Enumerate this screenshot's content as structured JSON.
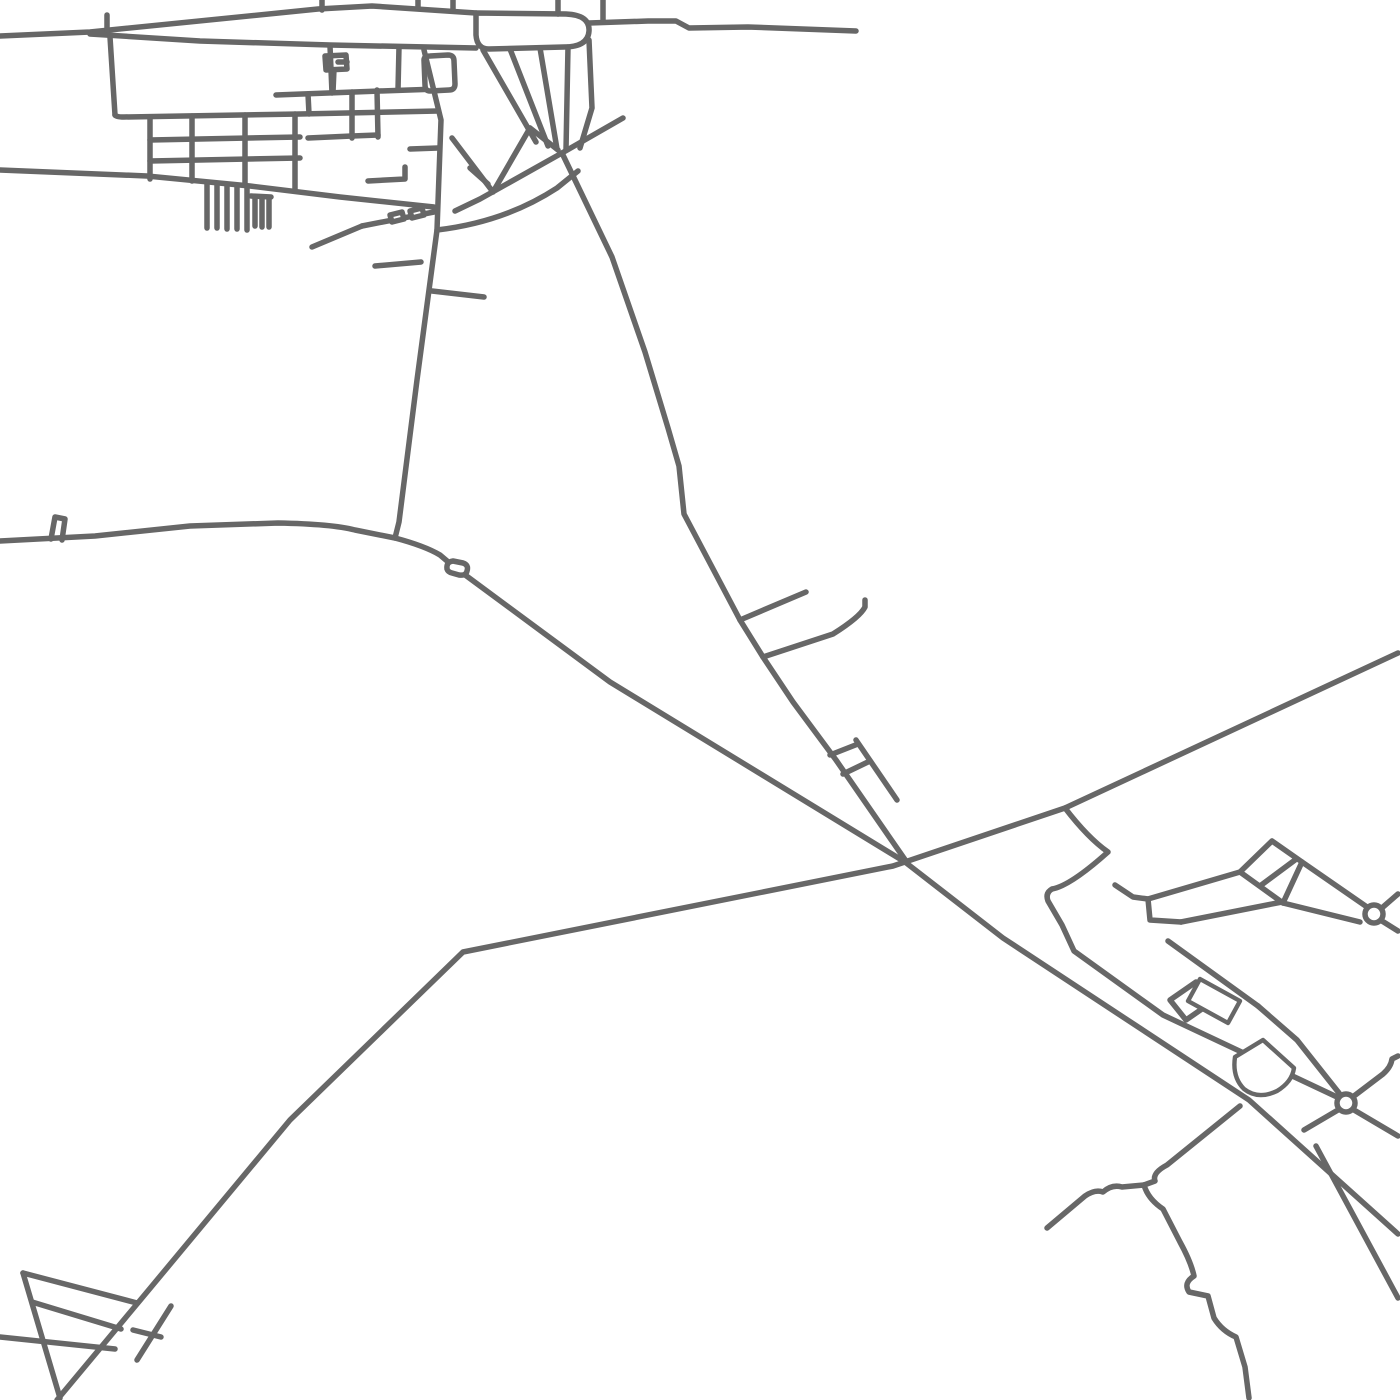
{
  "map": {
    "type": "minimal-road-map",
    "background_color": "#ffffff",
    "stroke_color": "#676767",
    "road_stroke_width": 5.5,
    "hatch_stroke_width": 3,
    "canvas": {
      "width": 1400,
      "height": 1400
    },
    "roundabouts": [
      {
        "name": "roundabout-east-upper",
        "cx": 1374,
        "cy": 914,
        "r": 9
      },
      {
        "name": "roundabout-east-lower",
        "cx": 1346,
        "cy": 1103,
        "r": 9
      }
    ],
    "roads": [
      {
        "group": "village-north",
        "name": "top-road-west",
        "d": "M 0,36 L 90,32 L 318,9 L 372,6 L 476,13"
      },
      {
        "group": "village-north",
        "name": "top-loop-pill",
        "closed": true,
        "d": "M 476,13 L 566,14 Q 590,15 589,31 Q 588,47 564,47 L 489,49 Q 477,49 476,35 Z"
      },
      {
        "group": "village-north",
        "name": "top-road-east",
        "d": "M 589,23 L 648,21 L 676,21 L 689,28 L 748,27 L 856,31"
      },
      {
        "group": "village-north",
        "name": "stub-x107",
        "d": "M 107,32 L 107,15"
      },
      {
        "group": "village-north",
        "name": "stub-x322",
        "d": "M 322,0 L 322,10"
      },
      {
        "group": "village-north",
        "name": "stub-x418",
        "d": "M 418,0 L 418,8"
      },
      {
        "group": "village-north",
        "name": "stub-x453",
        "d": "M 453,0 L 453,9"
      },
      {
        "group": "village-north",
        "name": "stub-x558",
        "d": "M 558,0 L 558,14"
      },
      {
        "group": "village-north",
        "name": "stub-x603",
        "d": "M 603,0 L 603,21"
      },
      {
        "group": "village-north",
        "name": "second-top-road",
        "d": "M 90,34 L 200,41 L 330,45 L 476,48"
      },
      {
        "group": "village-grid",
        "name": "block-left-edge",
        "d": "M 110,37 L 115,115"
      },
      {
        "group": "village-grid",
        "name": "grid-top-road",
        "d": "M 115,115 Q 116,117 124,117 L 300,114 L 438,111"
      },
      {
        "group": "village-grid",
        "name": "grid-row-1",
        "d": "M 150,140 L 300,137"
      },
      {
        "group": "village-grid",
        "name": "grid-row-2",
        "d": "M 150,161 L 300,158"
      },
      {
        "group": "village-grid",
        "name": "grid-col-1",
        "d": "M 150,117 L 150,179"
      },
      {
        "group": "village-grid",
        "name": "grid-col-2",
        "d": "M 192,116 L 192,181"
      },
      {
        "group": "village-grid",
        "name": "grid-col-3",
        "d": "M 245,115 L 245,185"
      },
      {
        "group": "village-grid",
        "name": "grid-col-4",
        "d": "M 295,114 L 295,190"
      },
      {
        "group": "village-grid",
        "name": "long-south-road",
        "d": "M 0,170 L 147,176 L 250,186 L 340,197 L 434,207"
      },
      {
        "group": "village-comb",
        "name": "comb-tooth-1",
        "d": "M 207,183 L 207,228"
      },
      {
        "group": "village-comb",
        "name": "comb-tooth-2",
        "d": "M 217,184 L 217,228"
      },
      {
        "group": "village-comb",
        "name": "comb-tooth-3",
        "d": "M 227,185 L 227,229"
      },
      {
        "group": "village-comb",
        "name": "comb-tooth-4",
        "d": "M 237,186 L 237,229"
      },
      {
        "group": "village-comb",
        "name": "comb-tooth-5",
        "d": "M 247,187 L 247,230"
      },
      {
        "group": "village-comb",
        "name": "comb-bar-2",
        "d": "M 251,196 L 271,197"
      },
      {
        "group": "village-comb",
        "name": "comb-tooth-6",
        "d": "M 255,197 L 255,226"
      },
      {
        "group": "village-comb",
        "name": "comb-tooth-7",
        "d": "M 262,198 L 262,227"
      },
      {
        "group": "village-comb",
        "name": "comb-tooth-8",
        "d": "M 269,198 L 269,227"
      },
      {
        "group": "village-center",
        "name": "flag-stem",
        "d": "M 333,92 L 334,69"
      },
      {
        "group": "village-center",
        "name": "flag-box",
        "closed": true,
        "d": "M 325,56 L 346,55 L 347,69 L 326,70 Z"
      },
      {
        "group": "village-center",
        "name": "flag-tick",
        "d": "M 338,62 L 347,62"
      },
      {
        "group": "village-center",
        "name": "mid-road-a",
        "d": "M 276,95 L 380,91 L 438,89"
      },
      {
        "group": "village-center",
        "name": "mid-vert-1",
        "d": "M 308,94 L 309,114"
      },
      {
        "group": "village-center",
        "name": "mid-vert-2",
        "d": "M 330,46 L 332,93"
      },
      {
        "group": "village-center",
        "name": "mid-vert-3",
        "d": "M 352,92 L 352,138"
      },
      {
        "group": "village-center",
        "name": "mid-cell-bar",
        "d": "M 308,138 L 352,136"
      },
      {
        "group": "village-center",
        "name": "mid-vert-4",
        "d": "M 377,90 L 378,137"
      },
      {
        "group": "village-center",
        "name": "mid-cell-bar-2",
        "d": "M 352,136 L 378,135"
      },
      {
        "group": "village-center",
        "name": "corner-road-1",
        "d": "M 368,181 L 405,179 L 405,167"
      },
      {
        "group": "village-center",
        "name": "corner-road-2",
        "d": "M 410,149 L 438,148"
      },
      {
        "group": "village-center",
        "name": "mid-vert-5",
        "d": "M 399,47 L 398,90"
      },
      {
        "group": "village-center",
        "name": "loop-square",
        "closed": true,
        "d": "M 424,60 Q 424,56 430,56 L 448,55 Q 454,55 454,61 L 455,84 Q 455,90 449,90 L 430,91 Q 425,91 425,85 Z"
      },
      {
        "group": "village-south",
        "name": "marks-access-lane",
        "d": "M 362,226 L 434,212"
      },
      {
        "group": "village-south",
        "name": "mark-box-1",
        "closed": true,
        "d": "M 390,215 L 402,212 L 404,219 L 392,222 Z"
      },
      {
        "group": "village-south",
        "name": "mark-box-2",
        "closed": true,
        "d": "M 410,211 L 422,208 L 424,215 L 412,218 Z"
      },
      {
        "group": "village-south",
        "name": "lane-southwest",
        "d": "M 362,226 L 312,247"
      },
      {
        "group": "village-south",
        "name": "short-road-1",
        "d": "M 375,266 L 421,262"
      },
      {
        "group": "village-south",
        "name": "short-road-2",
        "d": "M 432,291 L 484,297"
      },
      {
        "group": "arterials",
        "name": "village-vertical-road",
        "d": "M 424,50 L 441,120 L 437,230 L 417,380 L 399,522 L 395,538"
      },
      {
        "group": "village-funnel",
        "name": "cross-road-west",
        "d": "M 623,118 L 562,153 L 480,199 L 455,211"
      },
      {
        "group": "village-funnel",
        "name": "south-curve",
        "d": "M 437,230 Q 505,222 557,188 L 578,171"
      },
      {
        "group": "village-funnel",
        "name": "v-shape",
        "d": "M 452,138 L 493,192 L 530,128"
      },
      {
        "group": "village-funnel",
        "name": "v-inner",
        "d": "M 470,168 L 488,184"
      },
      {
        "group": "village-funnel",
        "name": "v-link",
        "d": "M 530,128 L 558,150"
      },
      {
        "group": "village-funnel",
        "name": "fan-1",
        "d": "M 483,50 L 536,142"
      },
      {
        "group": "village-funnel",
        "name": "fan-2",
        "d": "M 510,49 L 548,146"
      },
      {
        "group": "village-funnel",
        "name": "fan-3",
        "d": "M 540,48 L 557,149"
      },
      {
        "group": "village-funnel",
        "name": "fan-4",
        "d": "M 568,47 L 566,150"
      },
      {
        "group": "village-funnel",
        "name": "fan-5",
        "d": "M 589,40 L 592,108 L 580,148"
      },
      {
        "group": "arterials",
        "name": "long-road-south-from-village",
        "d": "M 562,153 L 612,257 L 645,352 L 668,428 L 679,466 L 684,514 L 740,620 L 763,657 L 793,702 L 836,760 L 908,864"
      },
      {
        "group": "arterials",
        "name": "west-east-main-road",
        "d": "M 0,541 L 95,536 L 190,526 L 278,523 Q 332,524 355,530 L 395,538 Q 425,546 440,555 L 453,566 L 610,682 L 905,862 L 1003,938 L 1249,1100 L 1398,1234"
      },
      {
        "group": "arterials",
        "name": "west-road-stub",
        "d": "M 51,539 L 55,517 L 65,519 L 62,540"
      },
      {
        "group": "arterials",
        "name": "west-road-bead",
        "closed": true,
        "d": "M 447,569 Q 446,562 453,561 L 463,563 Q 469,565 467,571 Q 466,576 459,575 L 452,573 Q 448,572 447,569 Z"
      },
      {
        "group": "arterials",
        "name": "southwest-northeast-road",
        "d": "M 57,1400 L 147,1292 L 290,1120 L 463,952 L 893,866 L 1065,808 L 1398,653"
      },
      {
        "group": "center-junction",
        "name": "spur-northeast",
        "d": "M 740,620 L 806,592"
      },
      {
        "group": "center-junction",
        "name": "hook-road",
        "d": "M 763,657 L 833,634 Q 860,617 865,607 L 865,600"
      },
      {
        "group": "center-junction",
        "name": "ladder-parallel",
        "d": "M 856,740 L 897,800"
      },
      {
        "group": "center-junction",
        "name": "ladder-rung-1",
        "d": "M 830,755 L 858,744"
      },
      {
        "group": "center-junction",
        "name": "ladder-rung-2",
        "d": "M 843,774 L 870,761"
      },
      {
        "group": "compound",
        "name": "claw-branch-road",
        "d": "M 1065,808 Q 1088,838 1108,852 Q 1070,886 1052,889 Q 1045,893 1048,901 L 1062,925 L 1074,951 L 1163,1015 L 1337,1097"
      },
      {
        "group": "compound",
        "name": "step-connector",
        "d": "M 1115,885 L 1133,897 L 1148,899 L 1150,920 L 1181,922"
      },
      {
        "group": "compound",
        "name": "link-to-square-top",
        "d": "M 1148,899 L 1240,872"
      },
      {
        "group": "compound",
        "name": "link-to-square-bottom",
        "d": "M 1181,922 L 1282,902"
      },
      {
        "group": "compound",
        "name": "tilted-square",
        "closed": true,
        "d": "M 1272,841 L 1302,862 L 1283,903 L 1240,872 Z"
      },
      {
        "group": "compound",
        "name": "tilted-square-divider",
        "d": "M 1260,886 L 1295,860"
      },
      {
        "group": "compound",
        "name": "corridor-upper",
        "d": "M 1302,862 L 1367,907"
      },
      {
        "group": "compound",
        "name": "corridor-lower",
        "d": "M 1283,903 L 1360,922"
      },
      {
        "group": "compound",
        "name": "roundabout1-stub-ne",
        "d": "M 1383,907 L 1398,894"
      },
      {
        "group": "compound",
        "name": "roundabout1-stub-se",
        "d": "M 1382,921 L 1398,931"
      },
      {
        "group": "compound",
        "name": "band-upper-edge",
        "d": "M 1168,941 L 1258,1006"
      },
      {
        "group": "compound",
        "name": "small-square",
        "closed": true,
        "d": "M 1170,1000 L 1196,982 L 1212,1002 L 1186,1020 Z"
      },
      {
        "group": "compound",
        "name": "band-upper-continuation",
        "d": "M 1258,1006 L 1297,1040 L 1339,1093"
      },
      {
        "group": "compound",
        "name": "roundabout2-stub-ne",
        "d": "M 1354,1096 L 1383,1074 Q 1391,1067 1392,1059 L 1398,1056"
      },
      {
        "group": "compound",
        "name": "roundabout2-stub-sw",
        "d": "M 1338,1110 L 1304,1130"
      },
      {
        "group": "compound",
        "name": "roundabout2-stub-se",
        "d": "M 1354,1110 L 1398,1136"
      },
      {
        "group": "southeast",
        "name": "corner-branch-road",
        "d": "M 1316,1146 L 1398,1298"
      },
      {
        "group": "southeast",
        "name": "wiggle-up-link",
        "d": "M 1240,1106 L 1167,1165 Q 1152,1173 1155,1181 L 1144,1185"
      },
      {
        "group": "southeast",
        "name": "wiggle-west-arm",
        "d": "M 1047,1228 L 1085,1196 Q 1095,1189 1103,1192 Q 1112,1184 1122,1187 L 1144,1185"
      },
      {
        "group": "southeast",
        "name": "wiggle-south-arm",
        "d": "M 1144,1185 Q 1148,1199 1163,1209 L 1180,1242 Q 1191,1262 1194,1276 Q 1183,1283 1189,1292 L 1208,1296 L 1214,1318 Q 1222,1331 1236,1337 L 1245,1367 L 1249,1398"
      },
      {
        "group": "southwest-triangle",
        "name": "triangle-line-1",
        "d": "M 23,1273 L 137,1303"
      },
      {
        "group": "southwest-triangle",
        "name": "triangle-line-2",
        "d": "M 23,1273 L 60,1398"
      },
      {
        "group": "southwest-triangle",
        "name": "triangle-line-3",
        "d": "M 0,1337 L 115,1349"
      },
      {
        "group": "southwest-triangle",
        "name": "triangle-line-4",
        "d": "M 32,1302 L 121,1329"
      },
      {
        "group": "southwest-triangle",
        "name": "h-structure-long",
        "d": "M 171,1306 L 137,1360"
      },
      {
        "group": "southwest-triangle",
        "name": "h-structure-bar",
        "d": "M 133,1330 L 161,1337"
      }
    ],
    "hatched_buildings": [
      {
        "name": "hatched-building-rect",
        "outline": "M 1200,979 L 1240,1001 L 1228,1023 L 1188,1001 Z",
        "hatch": [
          "M 1202,981 L 1238,1002",
          "M 1198,986 L 1233,1007",
          "M 1195,991 L 1230,1012",
          "M 1192,996 L 1226,1017",
          "M 1190,1001 L 1223,1021"
        ]
      },
      {
        "name": "hatched-building-fan",
        "outline": "M 1235,1057 L 1263,1040 L 1294,1068 Q 1292,1082 1277,1091 Q 1258,1100 1244,1089 Q 1232,1077 1235,1057 Z",
        "hatch": [
          "M 1246,1050 L 1281,1050",
          "M 1238,1058 L 1291,1058",
          "M 1236,1066 L 1292,1066",
          "M 1238,1074 L 1289,1074",
          "M 1243,1082 L 1283,1082",
          "M 1264,1044 L 1264,1090"
        ]
      }
    ]
  }
}
